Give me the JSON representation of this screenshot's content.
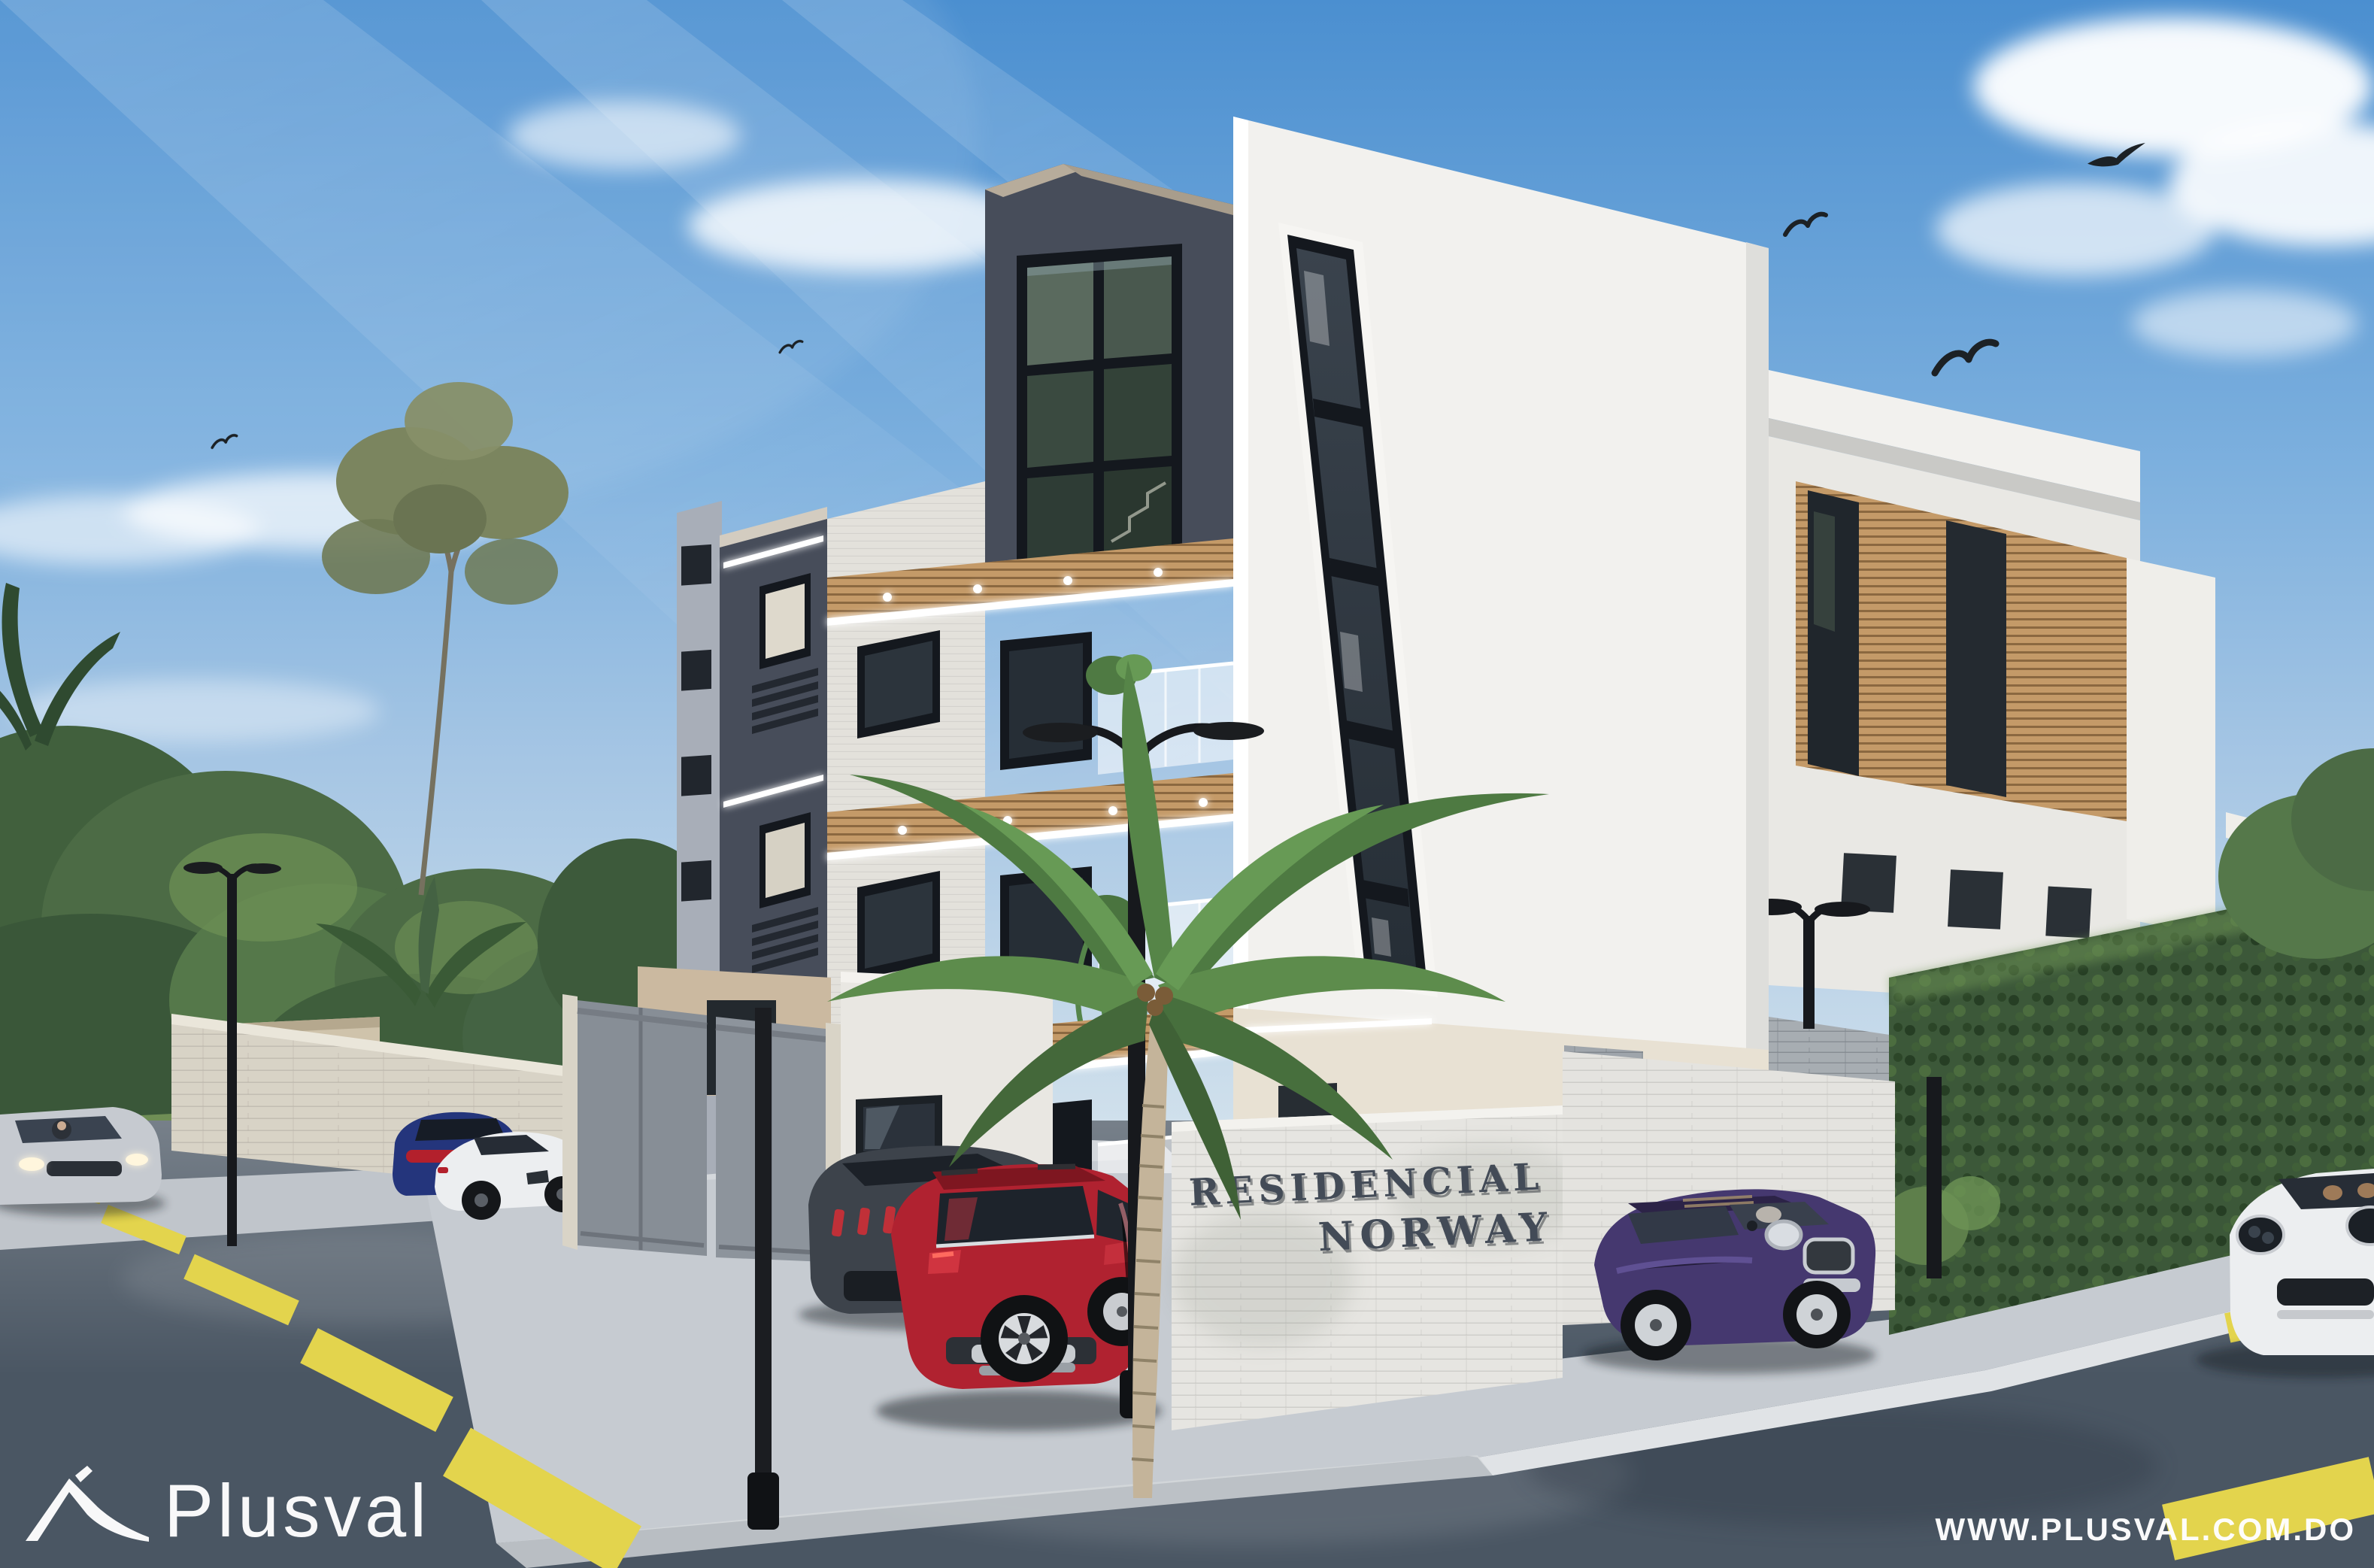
{
  "signage": {
    "line1": "RESIDENCIAL",
    "line2": "NORWAY"
  },
  "watermark": {
    "logo_text": "Plusval",
    "website": "WWW.PLUSVAL.COM.DO"
  },
  "colors": {
    "sky_top": "#4b8fd0",
    "sky_mid": "#a6c6e4",
    "sky_horizon": "#dde8ee",
    "cloud_white": "#ffffff",
    "building_white": "#f2f1ee",
    "building_white_shade": "#c6ccd3",
    "building_dark": "#474d5a",
    "building_dark_deep": "#343a46",
    "roof_beige": "#b7ac9b",
    "glass_dark": "#262e36",
    "glass_green": "#3c4b42",
    "frame_black": "#14181e",
    "wood": "#c49a68",
    "wood_deep": "#8a6844",
    "brick_cream": "#d8d3c6",
    "brick_sign": "#e6e5e1",
    "brick_gray": "#a7adb2",
    "gate_gray": "#878e96",
    "hedge_green": "#3c5839",
    "tree_green": "#4c6b45",
    "tree_light": "#6f9156",
    "eucalyptus": "#7b855f",
    "lawn": "#6f8e55",
    "palm_green": "#4e7a42",
    "palm_light": "#679a55",
    "trunk_tan": "#c4b49a",
    "asphalt_light": "#7b8a99",
    "asphalt_dark": "#4a5663",
    "sidewalk": "#c6cbd1",
    "curb": "#e0e3e6",
    "marking_yellow": "#e3d44d",
    "lamp_black": "#17191d",
    "sign_text": "#434b57",
    "car_red": "#b02230",
    "car_blue": "#24357c",
    "car_white": "#eceef0",
    "car_dark": "#3d434b",
    "car_purple": "#45386f",
    "car_silver": "#c6cad0",
    "watermark_white": "#ffffff"
  }
}
